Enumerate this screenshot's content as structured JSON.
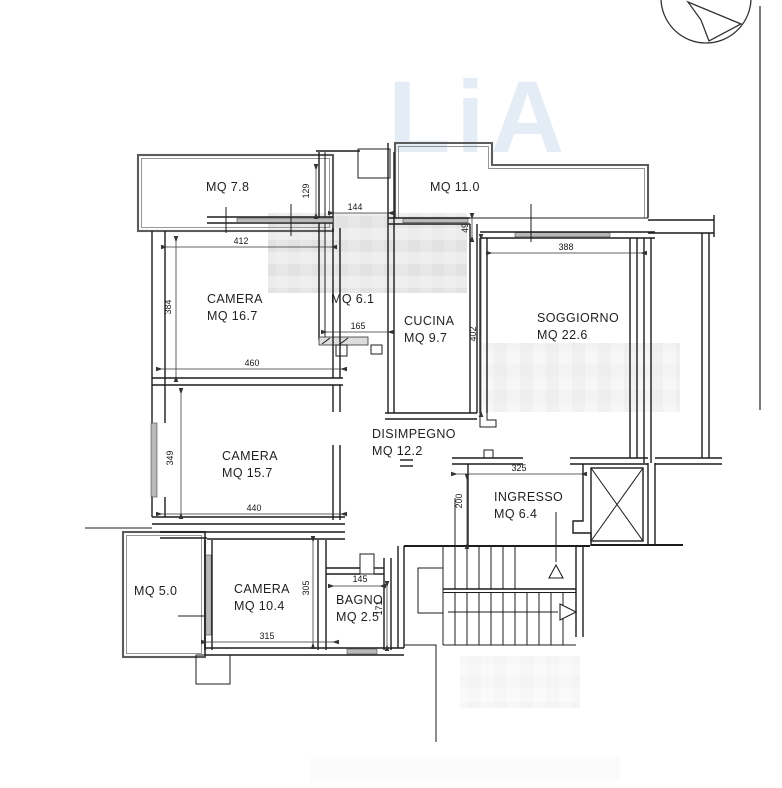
{
  "watermark": {
    "text": "LiA",
    "color": "#e4ecf5"
  },
  "plan": {
    "rooms": [
      {
        "name": "",
        "area": "MQ 7.8"
      },
      {
        "name": "",
        "area": "MQ 11.0"
      },
      {
        "name": "",
        "area": "MQ 6.1"
      },
      {
        "name": "CAMERA",
        "area": "MQ 16.7"
      },
      {
        "name": "CUCINA",
        "area": "MQ 9.7"
      },
      {
        "name": "SOGGIORNO",
        "area": "MQ 22.6"
      },
      {
        "name": "CAMERA",
        "area": "MQ 15.7"
      },
      {
        "name": "DISIMPEGNO",
        "area": "MQ 12.2"
      },
      {
        "name": "INGRESSO",
        "area": "MQ 6.4"
      },
      {
        "name": "",
        "area": "MQ 5.0"
      },
      {
        "name": "CAMERA",
        "area": "MQ 10.4"
      },
      {
        "name": "BAGNO",
        "area": "MQ 2.5"
      }
    ],
    "dimensions": [
      "412",
      "384",
      "144",
      "129",
      "49",
      "388",
      "165",
      "402",
      "460",
      "349",
      "440",
      "325",
      "200",
      "315",
      "305",
      "145",
      "171"
    ]
  },
  "colors": {
    "wall": "#1c1c1c",
    "balcony": "#5c5c5c",
    "window": "#b9b9b9",
    "dim_text": "#161616"
  }
}
